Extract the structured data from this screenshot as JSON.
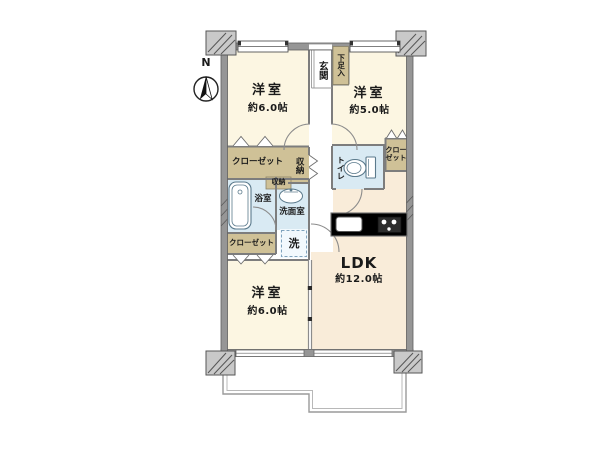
{
  "compass": {
    "north_label": "N"
  },
  "rooms": {
    "bedroom_top_left": {
      "name": "洋室",
      "size": "約6.0帖"
    },
    "bedroom_top_right": {
      "name": "洋室",
      "size": "約5.0帖"
    },
    "bedroom_bottom": {
      "name": "洋室",
      "size": "約6.0帖"
    },
    "ldk": {
      "name": "LDK",
      "size": "約12.0帖"
    },
    "entrance": {
      "name": "玄関"
    },
    "shoe_cabinet": {
      "name": "下足入"
    },
    "closet_top_left": {
      "name": "クローゼット"
    },
    "hall_storage": {
      "name": "収納"
    },
    "small_storage": {
      "name": "収納"
    },
    "bathroom": {
      "name": "浴室"
    },
    "washroom": {
      "name": "洗面室"
    },
    "laundry": {
      "name": "洗"
    },
    "closet_bottom_left": {
      "name": "クローゼット"
    },
    "toilet": {
      "name": "トイレ"
    },
    "closet_right": {
      "name": "クローゼット"
    }
  },
  "colors": {
    "room_floor": "#fcf6e2",
    "ldk_floor": "#f9ecd9",
    "closet": "#cfc197",
    "wet_area": "#d9eaf3",
    "laundry_box": "#f2f9fd",
    "wall": "#969696",
    "wall_edge": "#5f5f5f",
    "corner_block": "#c9c9c9",
    "line": "#7d7d7d"
  }
}
